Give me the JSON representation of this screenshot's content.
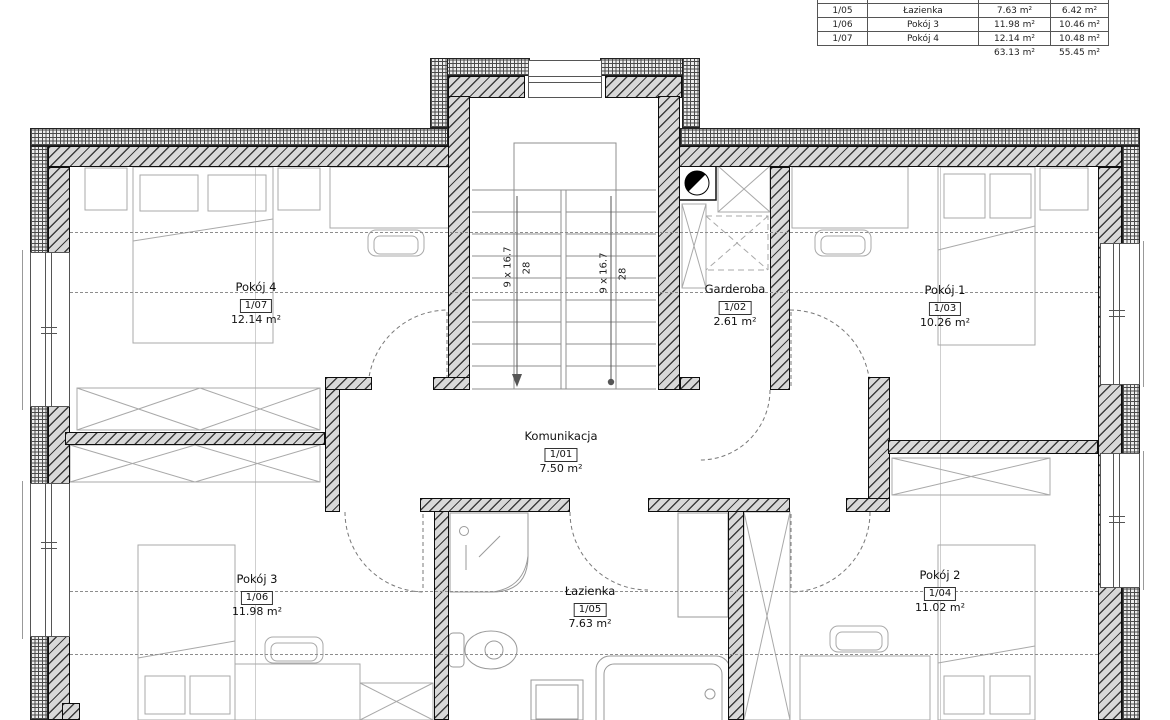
{
  "table": {
    "rows": [
      {
        "no": "1/05",
        "name": "Łazienka",
        "area": "7.63 m²",
        "usable": "6.42 m²"
      },
      {
        "no": "1/06",
        "name": "Pokój 3",
        "area": "11.98 m²",
        "usable": "10.46 m²"
      },
      {
        "no": "1/07",
        "name": "Pokój 4",
        "area": "12.14 m²",
        "usable": "10.48 m²"
      }
    ],
    "totals": {
      "area": "63.13 m²",
      "usable": "55.45 m²"
    }
  },
  "rooms": {
    "komunikacja": {
      "name": "Komunikacja",
      "no": "1/01",
      "area": "7.50 m²"
    },
    "garderoba": {
      "name": "Garderoba",
      "no": "1/02",
      "area": "2.61 m²"
    },
    "pokoj1": {
      "name": "Pokój 1",
      "no": "1/03",
      "area": "10.26 m²"
    },
    "pokoj2": {
      "name": "Pokój 2",
      "no": "1/04",
      "area": "11.02 m²"
    },
    "lazienka": {
      "name": "Łazienka",
      "no": "1/05",
      "area": "7.63 m²"
    },
    "pokoj3": {
      "name": "Pokój 3",
      "no": "1/06",
      "area": "11.98 m²"
    },
    "pokoj4": {
      "name": "Pokój 4",
      "no": "1/07",
      "area": "12.14 m²"
    }
  },
  "stairs": {
    "flight": "9 x 16.7",
    "width": "28"
  }
}
